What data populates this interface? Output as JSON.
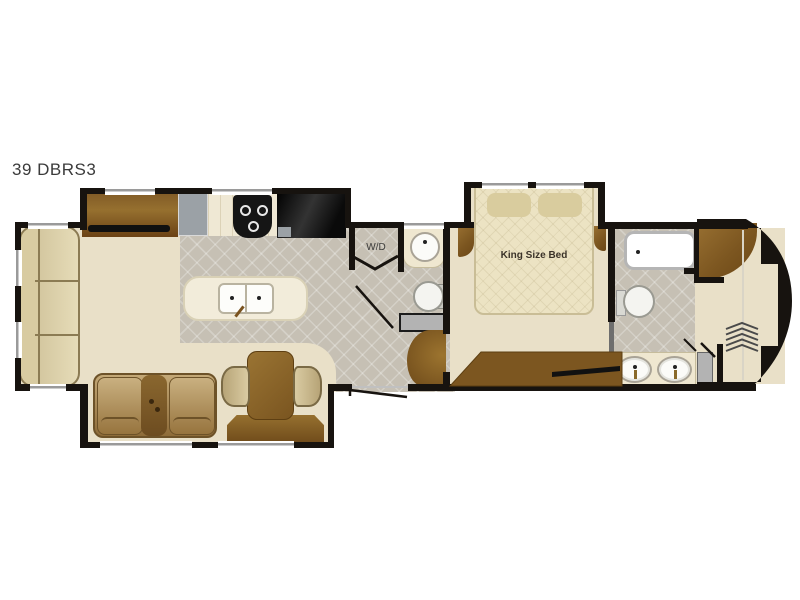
{
  "floorplan": {
    "model_label": "39 DBRS3",
    "labels": {
      "washer_dryer": "W/D",
      "king_bed": "King Size Bed"
    },
    "colors": {
      "walls": "#17130f",
      "tile_floor": "#c6c0b4",
      "carpet": "#e9e0c8",
      "wood_cabinetry": "#7c5620",
      "counter": "#efe8d4",
      "upholstery": "#cdbd92",
      "appliance_black": "#151515",
      "utility_gray": "#9ba1a6"
    },
    "fixtures": [
      "sofa",
      "entertainment-center-tv",
      "kitchen-counter",
      "stove",
      "refrigerator",
      "kitchen-island-sink",
      "washer-dryer-closet",
      "half-bath-vanity",
      "half-bath-toilet",
      "entry-steps",
      "dinette-table",
      "dinette-chairs",
      "buffet",
      "theater-seating",
      "king-bed",
      "nightstands",
      "bedroom-dresser-tv",
      "shower",
      "front-bath-toilet",
      "double-sink-vanity",
      "front-wardrobe-closet"
    ]
  }
}
